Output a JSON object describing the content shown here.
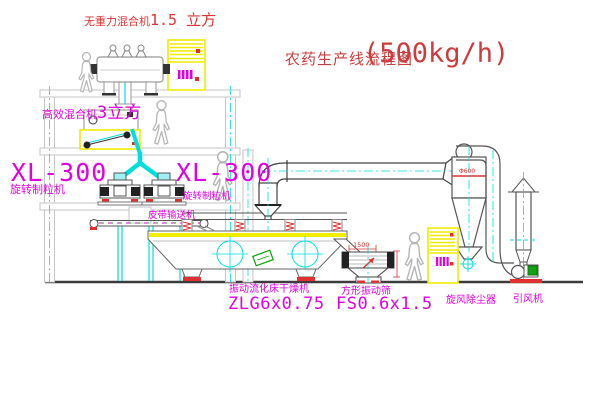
{
  "diagram": {
    "title": "农药生产线流程图",
    "capacity": "(500kg/h)"
  },
  "equipment": {
    "zero_gravity_mixer": {
      "name": "无重力混合机",
      "spec": "1.5 立方"
    },
    "high_efficiency_mixer": {
      "name": "高效混合机",
      "spec": "3立方"
    },
    "granulator_left": {
      "model": "XL-300",
      "name": "旋转制粒机"
    },
    "granulator_right": {
      "model": "XL-300",
      "name": "旋转制粒机"
    },
    "belt_conveyor": {
      "name": "皮带输送机"
    },
    "fluid_bed_dryer": {
      "name": "振动流化床干燥机",
      "model": "ZLG6x0.75"
    },
    "square_screen": {
      "name": "方形振动筛",
      "model": "FS0.6x1.5",
      "dim_width": "1500"
    },
    "cyclone": {
      "name": "旋风除尘器",
      "dim": "Φ600"
    },
    "fan": {
      "name": "引风机"
    }
  },
  "colors": {
    "label_magenta": "#e100e1",
    "label_red": "#e03030",
    "title_red": "#cd3c3c",
    "pipe_cyan": "#00dede",
    "cabinet_yellow": "#f0ec00",
    "motor_green": "#12a312"
  }
}
